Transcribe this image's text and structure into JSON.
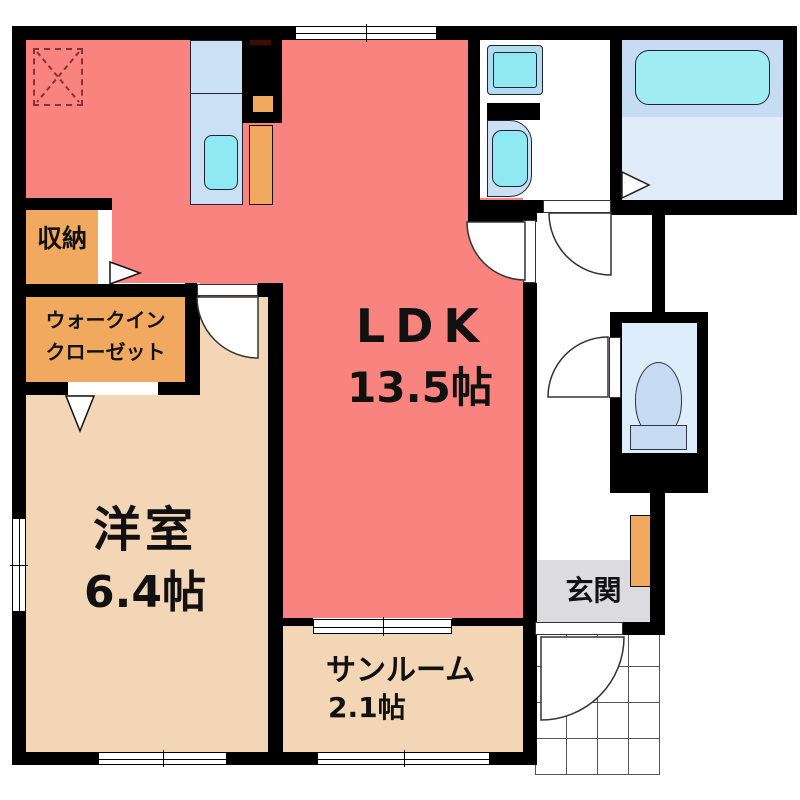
{
  "plan_title": "apartment-floor-plan",
  "rooms": {
    "ldk": {
      "name": "LDK",
      "size": "13.5帖"
    },
    "western_room": {
      "name": "洋室",
      "size": "6.4帖"
    },
    "sunroom": {
      "name": "サンルーム",
      "size": "2.1帖"
    },
    "entrance": {
      "name": "玄関"
    },
    "storage": {
      "name": "収納"
    },
    "walk_in_closet": {
      "name_line1": "ウォークイン",
      "name_line2": "クローゼット"
    }
  },
  "fixtures": {
    "kitchen_sink": "kitchen-counter-with-sink",
    "refrigerator_space": "refrigerator-space",
    "washing_machine_pan": "washing-machine-pan",
    "washbasin": "washbasin-vanity",
    "bathtub": "bathtub",
    "toilet": "toilet",
    "shoe_cabinet": "shoe-cabinet",
    "attic_access": "ceiling-access-dashed-square",
    "porch": "entrance-porch-tiles"
  },
  "colors": {
    "ldk_salmon": "#F8837F",
    "room_beige": "#F2D6B6",
    "closet_orange": "#F0A95F",
    "fixture_cyan": "#8FE9F2",
    "fixture_blue": "#C9E0F5",
    "bath_floor": "#DFECF8",
    "bathtub_zone": "#C5DCF2",
    "toilet_floor": "#DEEDFB",
    "toilet_fixture": "#C6DAF2",
    "entrance_gray": "#DCDCDE",
    "stove_dark_red": "#400B06",
    "wall_black": "#000000"
  }
}
